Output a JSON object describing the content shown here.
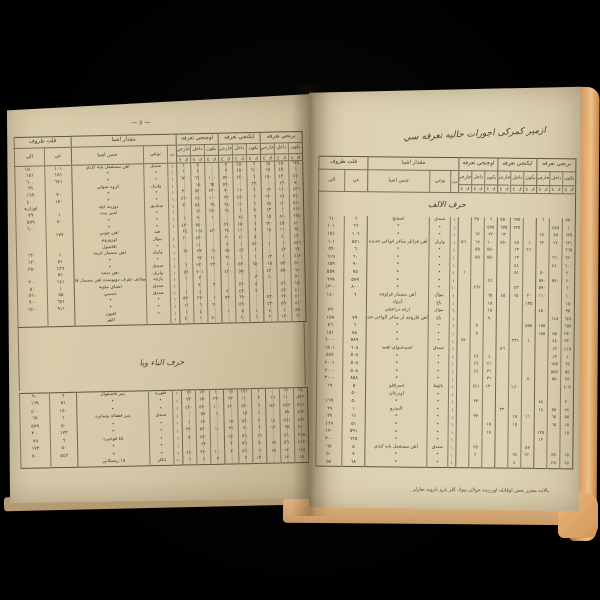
{
  "scene": {
    "background": "#000000",
    "page_color_left": "#d5c8a8",
    "page_color_right": "#ded3b5",
    "page_edge_color": "#d99c5f",
    "ink": "#43392b"
  },
  "columns": {
    "group_qillet": "قلت ظروف",
    "col_to": "الي",
    "col_from": "عن",
    "group_miqdar": "مقدار اشيا",
    "col_genus": "جنس اشيا",
    "col_type": "نوعي",
    "col_count": "عدد",
    "tariffs": [
      "اوچنجي تعرفه",
      "ايكنجي تعرفه",
      "برنجي تعرفه"
    ],
    "sub": [
      "خارجي",
      "داخل",
      "يكون"
    ],
    "micro": [
      "غ",
      "ق"
    ]
  },
  "left_page": {
    "page_marker": "— ٥ —",
    "section_title": "حرف الباء ويا",
    "table1": {
      "rows": [
        [
          "١٥٠٠",
          "١٠١",
          "آهن مستعمل پايه كندي",
          "صندق",
          "١",
          "١",
          "٤",
          "",
          "٧",
          "٤٥٠",
          "٦",
          "١٥",
          "٤٥٠",
          "٦٢٥"
        ],
        [
          "١٥١",
          "١٥١",
          "٭",
          "٭",
          "١",
          "١",
          "٤",
          "",
          "٧",
          "٤٥٠",
          "٦١٠",
          "١٥",
          "٤٥٠",
          "١"
        ],
        [
          "٦٠٠",
          "٦٧١",
          "٭",
          "٭",
          "١",
          "٦٢٠",
          "٦٦٠",
          "١٠٠",
          "٥٢٠",
          "٤٢٠",
          "٦",
          "١٥٠",
          "٤٢٠",
          "٥٦٠"
        ],
        [
          "٦٩",
          "",
          "كروه صولي",
          "واريل",
          "١",
          "",
          "١٥",
          "٦٥",
          "٥٦٠",
          "",
          "٢٦",
          "",
          "٢٦",
          "٩٠"
        ],
        [
          "١٦٩",
          "٧٠",
          "٭",
          "٭",
          "١",
          "٣٠",
          "٥٢٠",
          "٢٢٠",
          "٩٠",
          "١١٠",
          "٦",
          "١٣",
          "١١٠",
          "٤٢٦"
        ],
        [
          "٤٠٠",
          "١٧٠",
          "٭",
          "٭",
          "١",
          "٤٦٠",
          "٤٤٠",
          "١٠٠",
          "٢٢",
          "٤٤٠",
          "٦",
          "١٣٠",
          "٢٤",
          "٥٦٠"
        ],
        [
          "اوزاريه",
          "",
          "دوزينه ايله",
          "صناديق",
          "١",
          "٣٠",
          "٥٤٠",
          "٢٤",
          "٢٤",
          "١١٠",
          "٦",
          "١٥",
          "١١٠",
          "٥٦٠"
        ],
        [
          "٧٩",
          "١",
          "امين بيت",
          "٭",
          "١",
          "",
          "٤١",
          "٢٤٠",
          "١٤",
          "١",
          "٥",
          "١٣",
          "١",
          "٤١٢"
        ],
        [
          "٥٧٩",
          "٨٠",
          "٭",
          "٭",
          "١",
          "١",
          "٩٠",
          "١",
          "",
          "٨١",
          "٦",
          "١٥",
          "٨١٠",
          "٢٢٥"
        ],
        [
          "٦٠٠",
          "",
          "٭",
          "٭",
          "١",
          "٤٢٠",
          "٥٤٠",
          "",
          "٥٦٠",
          "٤٥٠",
          "٦",
          "٦٢٠",
          "٤٥٠",
          "٤١٠"
        ],
        [
          "",
          "١٧٧",
          "آهن چوبي",
          "فيه",
          "",
          "٢٤",
          "١١٤",
          "٤٢٠",
          "٢٤",
          "١١٠",
          "٦",
          "١٤",
          "١١٠",
          "٦٤٠"
        ],
        [
          "",
          "",
          "اوزوروم",
          "بيوال",
          "١",
          "٢٠",
          "٤٢٠",
          "",
          "٢٠",
          "٤٠",
          "٥",
          "",
          "٤٠",
          "١٢٠"
        ],
        [
          "",
          "",
          "افاصول",
          "٭",
          "١",
          "",
          "١١٠",
          "",
          "٢",
          "١",
          "٤٢٠",
          "١",
          "١",
          "٤٢٦"
        ],
        [
          "١٣٠",
          "١",
          "آهن مسمار كزمه",
          "واريل",
          "١",
          "٦٢",
          "٣٢",
          "١١",
          "٥٤",
          "٤٢",
          "١",
          "",
          "٤٢",
          "٢٤"
        ],
        [
          "١٢٠",
          "٥١",
          "٭",
          "٭",
          "١",
          "",
          "٢٢",
          "١١٠",
          "٢١",
          "١",
          "١",
          "١٣",
          "١",
          "٤١٢"
        ],
        [
          "٢٥٠",
          "١٢٦",
          "٭",
          "صندق",
          "١",
          "٦",
          "٢٣٠",
          "٢٣٠",
          "١",
          "٥٣٠",
          "٦٥٠",
          "١٥",
          "٥٣٠",
          "٥١٠"
        ],
        [
          "",
          "٥١",
          "آهن ايكنه",
          "واريل",
          "١",
          "٥٦",
          "٢٠١",
          "",
          "٤٢٠",
          "٥٥٠",
          "",
          "٤٢٠",
          "٥٥٠",
          "٦١٠"
        ],
        [
          "٢٠٠",
          "١٤١",
          "مقاتف ظرف دويومنده آهن مسمار قاروچه",
          "پارچه",
          "١",
          "١",
          "٣",
          "",
          "",
          "",
          "٣",
          "٤٠",
          "",
          "٥٠٠"
        ],
        [
          "٥٠",
          "١",
          "اشياي ملونه",
          "صندق",
          "١",
          "",
          "٩٠",
          "٣",
          "",
          "٥٦٠",
          "٥",
          "",
          "٥٦٠",
          "١٥٠"
        ],
        [
          "٥٦٠",
          "٥٥",
          "عدسي",
          "صندق",
          "١",
          "١",
          "٤",
          "",
          "٣٠",
          "٤٣٠",
          "٢",
          "",
          "٤٣٠",
          "٤٠٠"
        ],
        [
          "٩٠٠",
          "٦٧١",
          "٭",
          "٭",
          "١",
          "٥٣٠",
          "٢٣٠",
          "١",
          "٥٣٠",
          "٦٩٠",
          "",
          "٥٣٠",
          "٦٣٠",
          "٤٠٠"
        ],
        [
          "١٥٠٠",
          "٩١١",
          "٭",
          "٭",
          "١",
          "١١",
          "٦",
          "٢٠",
          "",
          "٥٩٠",
          "",
          "٤٣٠",
          "٥٩٠",
          "٤١٠"
        ],
        [
          "",
          "",
          "آفيون",
          "٭",
          "١",
          "١",
          "٤",
          "",
          "١",
          "٥",
          "١",
          "٤٠",
          "١",
          "٥٩٠"
        ],
        [
          "",
          "",
          "آكهر",
          "",
          "١",
          "٤٠",
          "١",
          "٥٠٠",
          "",
          "٤٠",
          "١",
          "٢٠",
          "١٣٠",
          "٢٠"
        ]
      ]
    },
    "table2": {
      "rows": [
        [
          "٩٠",
          "٦",
          "پنير قاشقوال",
          "طوربه",
          "١",
          "١٥",
          "٤٢",
          "١٠",
          "١٥",
          "٤٢١",
          "١",
          "",
          "٢١",
          "٢٤"
        ],
        [
          "١٦٩",
          "٥١",
          "٭",
          "٭",
          "١",
          "٢٢",
          "١٥٠",
          "٢٢٠",
          "٢٢",
          "١١٠",
          "٢",
          "١٦",
          "١١٠",
          "٥٢٢"
        ],
        [
          "٤٠٠",
          "١٥٠",
          "٭",
          "٭",
          "١",
          "٤٢٠",
          "٥٢٠",
          "١٠٠",
          "٤٢٠",
          "٥٢٠",
          "٦",
          "١٤٢٠",
          "٥٢٢",
          "٥٦١"
        ],
        [
          "٦٩",
          "١",
          "پنير قفقاله وسائره",
          "صندق",
          "١",
          "",
          "٥٩",
          "١",
          "",
          "١٥",
          "١",
          "",
          "٥٩",
          "٥٦٢"
        ],
        [
          "٥٧٩",
          "٥٠",
          "٭",
          "٭",
          "١",
          "١",
          "٢٢",
          "",
          "١٥",
          "٥٦٠",
          "٢",
          "١٤",
          "٥٦١",
          "٥٦٢"
        ],
        [
          "٣٠٠",
          "١٧٢",
          "٭",
          "٭",
          "١",
          "٢٢٠",
          "٥٢٠",
          "١٠",
          "٢٢",
          "٩٠",
          "٦",
          "١٢",
          "٩٩",
          "٢٤٠"
        ],
        [
          "٧٩",
          "٦",
          "٤٥ قوخيره",
          "٭",
          "١",
          "٥",
          "٤٣٠",
          "",
          "١٥٠",
          "٥٦٠",
          "١٦",
          "",
          "٥٦٠",
          "٢٢٥"
        ],
        [
          "١٧٢",
          "٥٠",
          "٭",
          "٭",
          "١",
          "",
          "٢٢",
          "",
          "٣",
          "٥٦٠",
          "٥",
          "١٥",
          "٥٦٠",
          "٤١٢"
        ],
        [
          "٧٠٠",
          "٥٤٢",
          "٭",
          "٭",
          "١",
          "٤٤٠",
          "٢٢٠",
          "١٠٠",
          "٣",
          "٥٦٠",
          "٦",
          "١٥",
          "١٣٠",
          "١١٥"
        ],
        [
          "",
          "",
          "١٥ رشتكاني",
          "آنكلر",
          "١٠",
          "١",
          "٤",
          "٣",
          "",
          "٣",
          "١٣٠",
          "",
          "١٣٠",
          "١٥"
        ]
      ]
    }
  },
  "right_page": {
    "title": "ازمير كمركى اجورات حاليه تعرفه سي",
    "section_title": "حرف الالف",
    "footnote": "بالاده محرر بعض اوقاتله اوزرنده جولان بيوك كلر بارو باروبه تعارلر .",
    "table": {
      "rows": [
        [
          "٦١",
          "٦",
          "اسفنج",
          "صندق",
          "١",
          "",
          "٣٥٠",
          "٦",
          "٥٥٠",
          "٦٧٥",
          "",
          "٦",
          "",
          "٥٥٠"
        ],
        [
          "١٠١",
          "٦٦",
          "٭",
          "٭",
          "١",
          "",
          "",
          "٥٧٥",
          "٦٧٥",
          "٩٢٥",
          "",
          "",
          "٥٤٥",
          "١"
        ],
        [
          "١٥١",
          "١٠٦",
          "٭",
          "٭",
          "١",
          "",
          "٦٢",
          "٢٢",
          "٦٢",
          "",
          "",
          "١٥٠",
          "٤٥",
          "٦٢٥"
        ],
        [
          "٦٠١",
          "٥٧١",
          "آهن قزانلر ساغر انواعي جديده",
          "واريل",
          "١",
          "٥٦٠",
          "٦٢",
          "١٠٠",
          "٤٥٠",
          "٤٥",
          "١",
          "٦٣٠",
          "٢٤",
          "٦٢١"
        ],
        [
          "٥٩",
          "٦",
          "٭",
          "٭",
          "١",
          "",
          "٥٥",
          "٥٥٠",
          "",
          "١٣",
          "٦٦٠",
          "",
          "",
          "٦٦٥"
        ],
        [
          "٦١٩",
          "٦٠",
          "٭",
          "٭",
          "١",
          "",
          "٥٥",
          "٥٥٠",
          "",
          "١٣",
          "",
          "",
          "٦٦٠",
          "٦٣٠"
        ],
        [
          "١٥٩",
          "٩٠",
          "٭",
          "٭",
          "١",
          "",
          "",
          "",
          "",
          "٤٤",
          "",
          "",
          "٤٤٠",
          "٦٠٠"
        ],
        [
          "٥٥٩",
          "٧٥",
          "٭",
          "٭",
          "١",
          "١",
          "",
          "",
          "",
          "٤٤",
          "",
          "٥٠",
          "",
          "٢٠"
        ],
        [
          "٦٩٩",
          "٥٧٩",
          "٭",
          "٭",
          "١",
          "",
          "",
          "٤٤",
          "",
          "",
          "",
          "٥٩٠",
          "٥٩٠",
          "٢٠"
        ],
        [
          "١٣٠٠",
          "٨٠٠",
          "٭",
          "٭",
          "١٠",
          "",
          "٤٦٢",
          "",
          "",
          "٤٣",
          "",
          "٥٩٠",
          "",
          "٦٠"
        ],
        [
          "١٤٠",
          "٦",
          "آهن مسمار قراوچه",
          "بيوال",
          "١",
          "",
          "",
          "٦٥",
          "٤٥",
          "١٥",
          "٣٠",
          "١١٠",
          "",
          "١٠"
        ],
        [
          "",
          "",
          "كروك",
          "باغ",
          "١",
          "",
          "",
          "١٥",
          "",
          "",
          "١٣٥",
          "",
          "",
          "١٥"
        ],
        [
          "٧٩",
          "",
          "آرانه دراعتلي",
          "بيوال",
          "٦",
          "",
          "",
          "١٥",
          "",
          "",
          "",
          "٤٥٠",
          "",
          "٣٥"
        ],
        [
          "١٥٩",
          "٧٩",
          "آهن قاروجه لر ساغر الواحي جديده",
          "باغ",
          "١",
          "",
          "",
          "٩٠",
          "",
          "",
          "",
          "",
          "٦١٥",
          "٦٢٥"
        ],
        [
          "٥٦",
          "٦",
          "٭",
          "٭",
          "١",
          "",
          "٥",
          "",
          "",
          "",
          "٥٥٥",
          "١٥٥",
          "",
          "٦٥٥"
        ],
        [
          "١٥١",
          "٥٨",
          "٭",
          "٭",
          "١",
          "",
          "٥",
          "",
          "",
          "",
          "",
          "١٥٥",
          "٥٥",
          "٣٣٠"
        ],
        [
          "٦٠٠٠",
          "٥٨٩",
          "٭",
          "٭",
          "١",
          "٥٢",
          "",
          "",
          "",
          "٣٣١",
          "١",
          "",
          "٤٤",
          "٣٣٠"
        ],
        [
          "١٥٠١",
          "٦٠٨",
          "اسيدجيواي آهنيه",
          "صندق",
          "١",
          "",
          "",
          "",
          "٥٦",
          "",
          "",
          "",
          "١٣",
          "٤١٥"
        ],
        [
          "٥٤٥",
          "٥٠٨",
          "٭",
          "٭",
          "١",
          "",
          "٤٤",
          "٤",
          "",
          "",
          "",
          "",
          "١٣",
          "١"
        ],
        [
          "٢٠٠١",
          "٥٠٨",
          "٭",
          "٭",
          "١",
          "",
          "٤٤",
          "٤١",
          "",
          "",
          "",
          "",
          "١٥٥",
          "٦٥"
        ],
        [
          "٢٠٠٠",
          "٥٠٨",
          "٭",
          "٭",
          "١",
          "",
          "٤٤",
          "٣١",
          "",
          "",
          "",
          "",
          "٥٥٥",
          "٥٥"
        ],
        [
          "٣٠٠٠",
          "٨٥٨",
          "٭",
          "٭",
          "١",
          "",
          "",
          "٣١",
          "",
          "",
          "٤",
          "",
          "٥٥",
          "٤٥"
        ],
        [
          "٦٩",
          "٥",
          "اسرافلو",
          "بالوط",
          "١",
          "",
          "٤٤١",
          "١٣٠",
          "",
          "١٫١٠",
          "",
          "",
          "",
          "٤٠٥"
        ],
        [
          "",
          "٥٠",
          "اودرغان",
          "٭",
          "١",
          "",
          "",
          "",
          "",
          "",
          "",
          "",
          "",
          ""
        ],
        [
          "١٦٩",
          "٥٠",
          "٭",
          "٭",
          "١",
          "",
          "٣٣",
          "",
          "",
          "",
          "",
          "٤٤",
          "",
          "٣٠"
        ],
        [
          "٦٩",
          "١",
          "البيدرو",
          "٭",
          "١",
          "",
          "",
          "",
          "٣٣",
          "",
          "",
          "١٤",
          "٥٥",
          "٢٤"
        ],
        [
          "٦٩",
          "٦١",
          "٭",
          "٭",
          "١",
          "",
          "٣٣",
          "",
          "",
          "١٥",
          "١١",
          "",
          "٦٥",
          "٥٥"
        ],
        [
          "١٦٩",
          "٥١",
          "٭",
          "٭",
          "١",
          "",
          "",
          "١٥",
          "",
          "١٥",
          "",
          "",
          "٦٥",
          "١٥"
        ],
        [
          "١٧٠",
          "٥٩١",
          "٭",
          "٭",
          "١",
          "",
          "",
          "١٥",
          "",
          "",
          "",
          "١٣٥",
          "",
          "١٥"
        ],
        [
          "٣٠٠",
          "٦٢٥",
          "٭",
          "٭",
          "١",
          "",
          "",
          "",
          "",
          "",
          "",
          "١٣",
          "",
          ""
        ],
        [
          "٦٩",
          "٥",
          "آهن مستعمل پايه كندي",
          "صندق",
          "١",
          "",
          "٢٥",
          "",
          "",
          "",
          "٥٧",
          "",
          "",
          ""
        ],
        [
          "٥٠",
          "٧",
          "٭",
          "٭",
          "١",
          "",
          "٤",
          "",
          "",
          "١٥",
          "١٢٠",
          "",
          "٣٥",
          "١٥"
        ],
        [
          "٥٨",
          "٦٨",
          "٭",
          "٭",
          "١",
          "",
          "",
          "",
          "",
          "٤",
          "",
          "",
          "٢٥",
          "١٥"
        ]
      ]
    }
  }
}
